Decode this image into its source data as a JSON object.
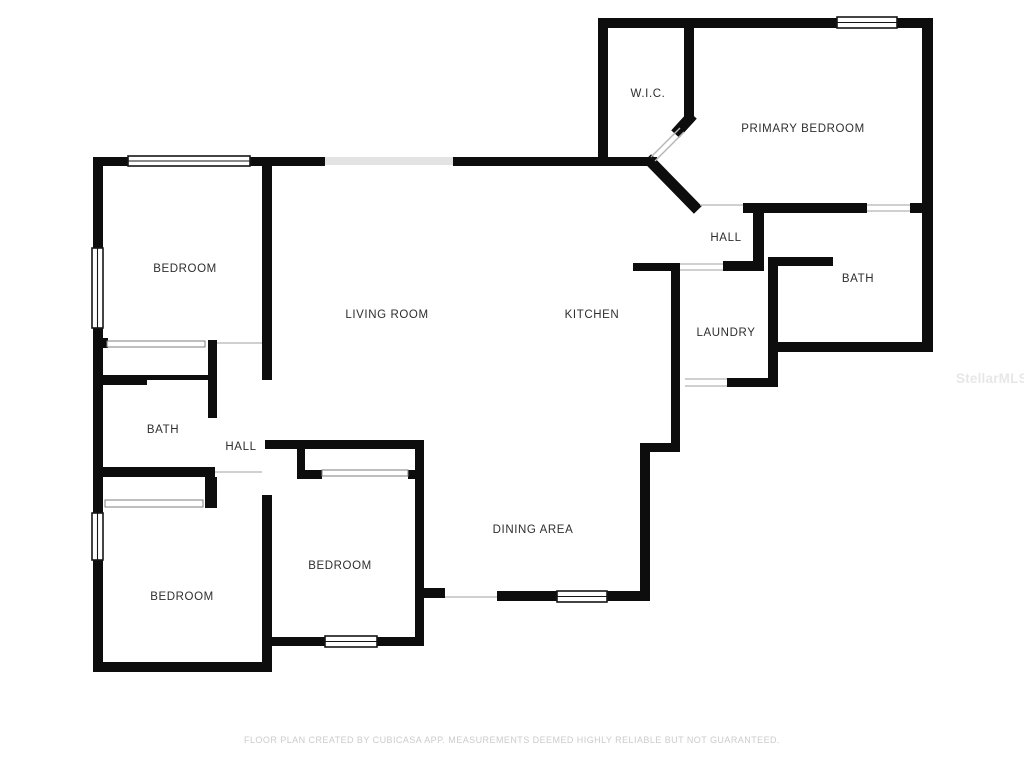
{
  "meta": {
    "footer": "FLOOR PLAN CREATED BY CUBICASA APP. MEASUREMENTS DEEMED HIGHLY RELIABLE BUT NOT GUARANTEED.",
    "watermark": "StellarMLS"
  },
  "palette": {
    "background": "#ffffff",
    "wall": "#0d0d0d",
    "light_wall": "#e3e3e3",
    "opening_line": "#b5b5b5",
    "closet_line": "#7d7d7d",
    "window_border": "#161616",
    "label": "#2e2e2e"
  },
  "canvas": {
    "width": 1024,
    "height": 768
  },
  "rooms": [
    {
      "id": "primary-bedroom",
      "label": "PRIMARY BEDROOM",
      "x": 803,
      "y": 128
    },
    {
      "id": "wic",
      "label": "W.I.C.",
      "x": 648,
      "y": 93
    },
    {
      "id": "hall-right",
      "label": "HALL",
      "x": 726,
      "y": 237
    },
    {
      "id": "bath-right",
      "label": "BATH",
      "x": 858,
      "y": 278
    },
    {
      "id": "laundry",
      "label": "LAUNDRY",
      "x": 726,
      "y": 332
    },
    {
      "id": "kitchen",
      "label": "KITCHEN",
      "x": 592,
      "y": 314
    },
    {
      "id": "living-room",
      "label": "LIVING ROOM",
      "x": 387,
      "y": 314
    },
    {
      "id": "dining-area",
      "label": "DINING AREA",
      "x": 533,
      "y": 529
    },
    {
      "id": "bedroom-top-left",
      "label": "BEDROOM",
      "x": 185,
      "y": 268
    },
    {
      "id": "bath-left",
      "label": "BATH",
      "x": 163,
      "y": 429
    },
    {
      "id": "hall-left",
      "label": "HALL",
      "x": 241,
      "y": 446
    },
    {
      "id": "bedroom-middle",
      "label": "BEDROOM",
      "x": 340,
      "y": 565
    },
    {
      "id": "bedroom-bottom-left",
      "label": "BEDROOM",
      "x": 182,
      "y": 596
    }
  ],
  "walls": [
    [
      93,
      157,
      10,
      91
    ],
    [
      93,
      328,
      10,
      185
    ],
    [
      93,
      560,
      10,
      112
    ],
    [
      93,
      157,
      37,
      9
    ],
    [
      247,
      157,
      78,
      9
    ],
    [
      453,
      157,
      204,
      9
    ],
    [
      262,
      165,
      10,
      215
    ],
    [
      98,
      338,
      10,
      10
    ],
    [
      93,
      375,
      54,
      10
    ],
    [
      147,
      375,
      70,
      5
    ],
    [
      208,
      340,
      9,
      78
    ],
    [
      93,
      467,
      122,
      10
    ],
    [
      205,
      477,
      12,
      31
    ],
    [
      262,
      495,
      10,
      177
    ],
    [
      93,
      662,
      179,
      10
    ],
    [
      265,
      440,
      158,
      9
    ],
    [
      415,
      440,
      9,
      206
    ],
    [
      262,
      637,
      63,
      9
    ],
    [
      377,
      637,
      47,
      9
    ],
    [
      297,
      448,
      8,
      30
    ],
    [
      297,
      470,
      25,
      9
    ],
    [
      408,
      470,
      16,
      9
    ],
    [
      423,
      588,
      22,
      10
    ],
    [
      497,
      591,
      60,
      10
    ],
    [
      607,
      591,
      43,
      10
    ],
    [
      640,
      443,
      10,
      158
    ],
    [
      640,
      443,
      40,
      9
    ],
    [
      671,
      271,
      9,
      181
    ],
    [
      633,
      263,
      47,
      8
    ],
    [
      723,
      261,
      41,
      10
    ],
    [
      753,
      207,
      11,
      58
    ],
    [
      727,
      378,
      46,
      9
    ],
    [
      768,
      257,
      10,
      130
    ],
    [
      778,
      257,
      55,
      9
    ],
    [
      768,
      342,
      165,
      10
    ],
    [
      922,
      18,
      11,
      334
    ],
    [
      598,
      18,
      239,
      10
    ],
    [
      897,
      18,
      36,
      10
    ],
    [
      598,
      28,
      10,
      137
    ],
    [
      684,
      28,
      10,
      93
    ],
    [
      743,
      203,
      124,
      10
    ],
    [
      910,
      203,
      12,
      10
    ]
  ],
  "light_walls": [
    [
      325,
      157,
      128,
      8
    ]
  ],
  "diagonal_walls": [
    {
      "x1": 651,
      "y1": 162,
      "x2": 694,
      "y2": 206,
      "w": 11
    },
    {
      "x1": 689,
      "y1": 119,
      "x2": 679,
      "y2": 130,
      "w": 11
    }
  ],
  "wic_door_lines": [
    {
      "x1": 651,
      "y1": 157,
      "x2": 680,
      "y2": 128
    },
    {
      "x1": 655,
      "y1": 161,
      "x2": 684,
      "y2": 132
    }
  ],
  "door_lines": [
    {
      "x1": 700,
      "y1": 205,
      "x2": 743,
      "y2": 205
    },
    {
      "x1": 867,
      "y1": 205,
      "x2": 910,
      "y2": 205
    },
    {
      "x1": 867,
      "y1": 211,
      "x2": 910,
      "y2": 211
    },
    {
      "x1": 680,
      "y1": 264,
      "x2": 723,
      "y2": 264
    },
    {
      "x1": 680,
      "y1": 270,
      "x2": 723,
      "y2": 270
    },
    {
      "x1": 685,
      "y1": 379,
      "x2": 727,
      "y2": 379
    },
    {
      "x1": 685,
      "y1": 386,
      "x2": 727,
      "y2": 386
    },
    {
      "x1": 445,
      "y1": 597,
      "x2": 497,
      "y2": 597
    },
    {
      "x1": 217,
      "y1": 343,
      "x2": 262,
      "y2": 343
    },
    {
      "x1": 215,
      "y1": 472,
      "x2": 262,
      "y2": 472
    }
  ],
  "closet_doors": [
    [
      107,
      341,
      98,
      6
    ],
    [
      105,
      500,
      98,
      7
    ],
    [
      322,
      470,
      86,
      6
    ]
  ],
  "windows": [
    {
      "x": 837,
      "y": 17,
      "w": 60,
      "h": 11,
      "orient": "h"
    },
    {
      "x": 128,
      "y": 156,
      "w": 122,
      "h": 10,
      "orient": "h"
    },
    {
      "x": 92,
      "y": 248,
      "w": 11,
      "h": 80,
      "orient": "v"
    },
    {
      "x": 92,
      "y": 513,
      "w": 11,
      "h": 47,
      "orient": "v"
    },
    {
      "x": 325,
      "y": 636,
      "w": 52,
      "h": 11,
      "orient": "h"
    },
    {
      "x": 557,
      "y": 591,
      "w": 50,
      "h": 11,
      "orient": "h"
    }
  ]
}
